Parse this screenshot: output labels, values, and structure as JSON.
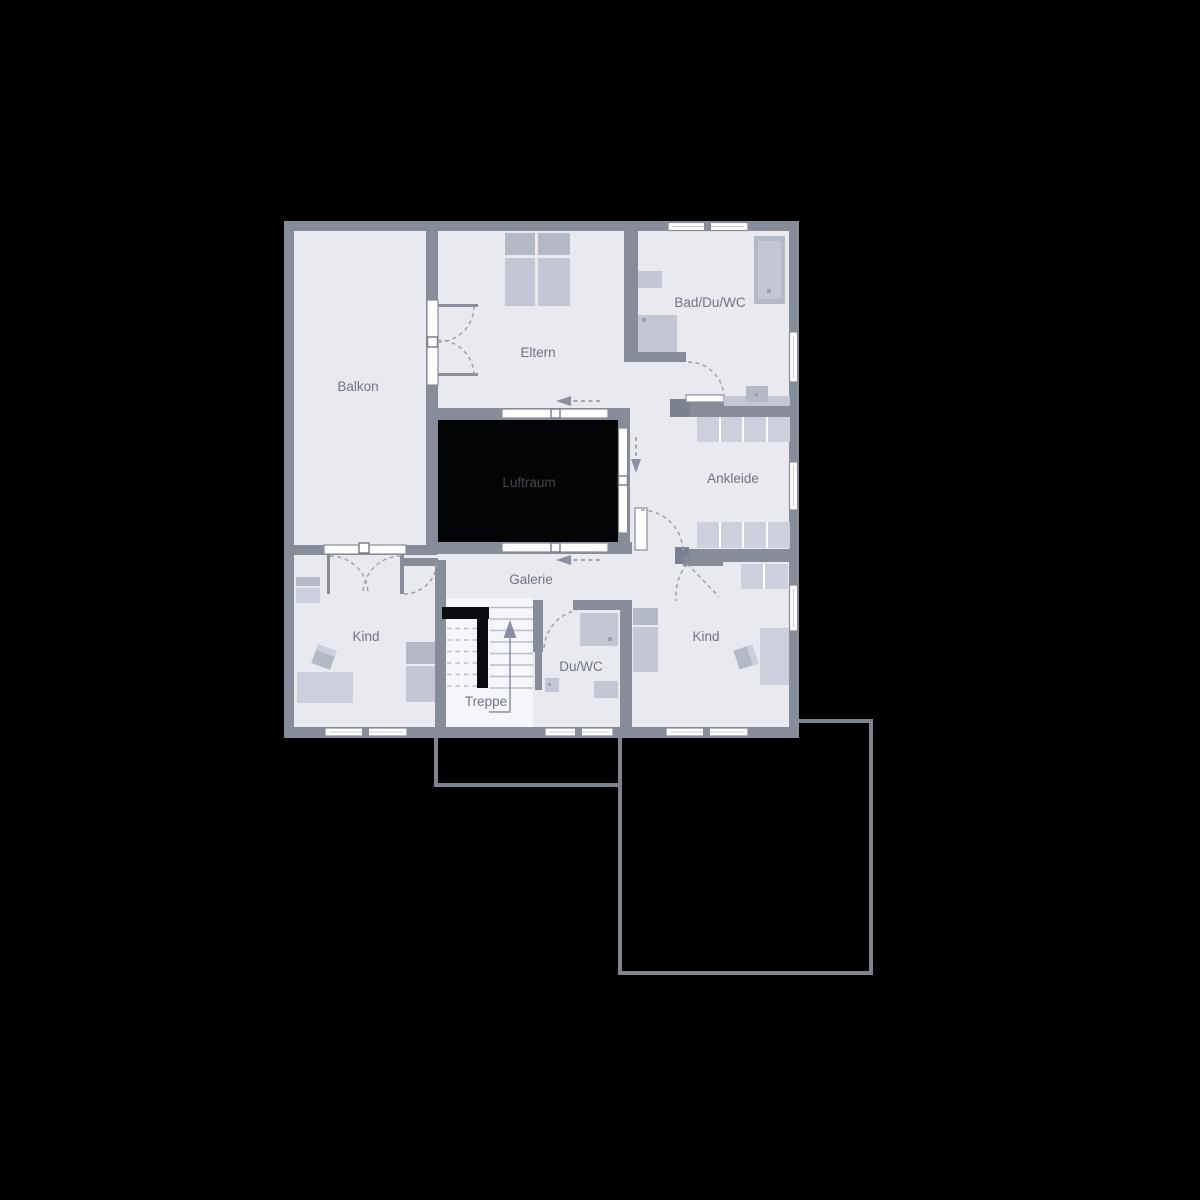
{
  "plan": {
    "rooms": [
      {
        "id": "balkon",
        "label": "Balkon"
      },
      {
        "id": "eltern",
        "label": "Eltern"
      },
      {
        "id": "bad_du_wc",
        "label": "Bad/Du/WC"
      },
      {
        "id": "luftraum",
        "label": "Luftraum"
      },
      {
        "id": "ankleide",
        "label": "Ankleide"
      },
      {
        "id": "galerie",
        "label": "Galerie"
      },
      {
        "id": "kind_left",
        "label": "Kind"
      },
      {
        "id": "treppe",
        "label": "Treppe"
      },
      {
        "id": "du_wc",
        "label": "Du/WC"
      },
      {
        "id": "kind_right",
        "label": "Kind"
      }
    ],
    "colors": {
      "background": "#000000",
      "wall": "#868c98",
      "room_fill": "#e8eaf0",
      "stair_fill": "#f5f6f9",
      "void_fill": "#030405",
      "furniture_light": "#cbd0dc",
      "furniture_dark": "#b3b9c5",
      "door_window_white": "#ffffff",
      "label_text": "#6e7482",
      "void_label_text": "#43474f",
      "lower_floor_outline": "#7f858f"
    }
  }
}
